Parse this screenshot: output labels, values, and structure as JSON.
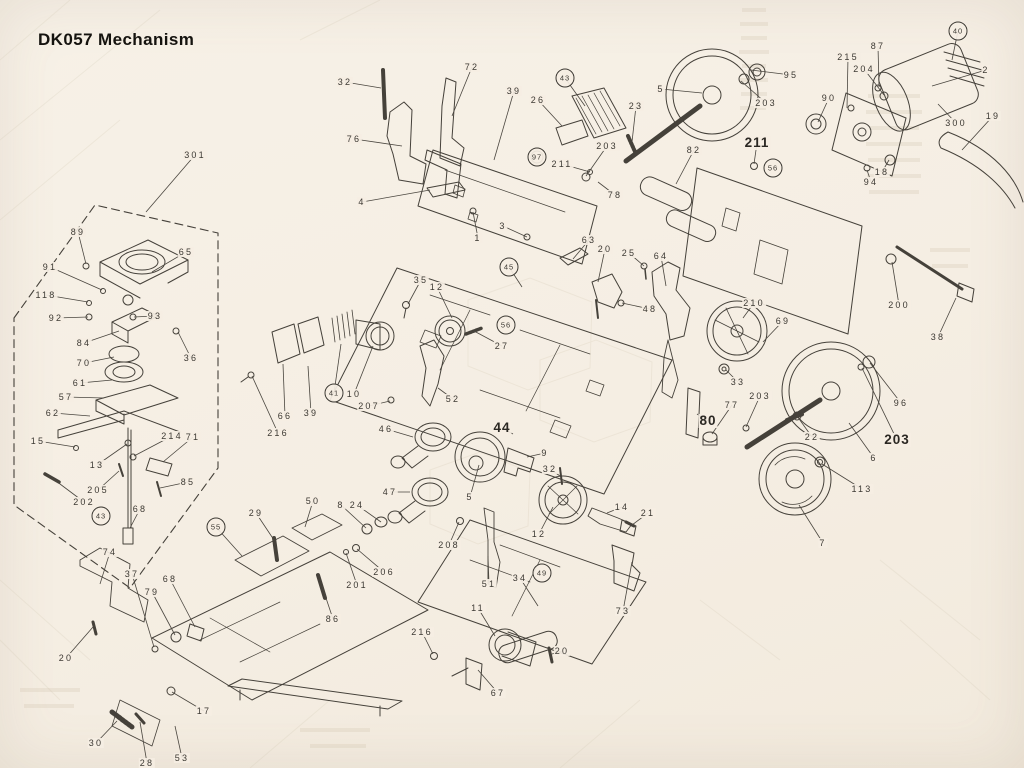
{
  "title": "DK057 Mechanism",
  "document_type": "exploded-view parts diagram (scanned service manual page)",
  "colors": {
    "paper": "#f5eee3",
    "ink": "#45413a",
    "title_ink": "#15130f",
    "ghost_bleedthrough": "#d6cab7"
  },
  "diagram": {
    "description": "Exploded isometric mechanism drawing with numbered part callouts and leader lines; a dashed boundary encloses a sub-assembly at left.",
    "label_styles": {
      "plain": "small letter-spaced number",
      "b": "large bold number",
      "c": "number inside circle"
    },
    "labels": [
      {
        "n": "301",
        "x": 195,
        "y": 155,
        "t": [
          146,
          212
        ]
      },
      {
        "n": "89",
        "x": 78,
        "y": 232,
        "t": [
          86,
          264
        ]
      },
      {
        "n": "65",
        "x": 186,
        "y": 252,
        "t": [
          152,
          272
        ]
      },
      {
        "n": "91",
        "x": 50,
        "y": 267,
        "t": [
          102,
          290
        ]
      },
      {
        "n": "118",
        "x": 46,
        "y": 295,
        "t": [
          88,
          302
        ]
      },
      {
        "n": "92",
        "x": 56,
        "y": 318,
        "t": [
          88,
          317
        ]
      },
      {
        "n": "93",
        "x": 155,
        "y": 316,
        "t": [
          134,
          317
        ]
      },
      {
        "n": "84",
        "x": 84,
        "y": 343,
        "t": [
          119,
          331
        ]
      },
      {
        "n": "36",
        "x": 191,
        "y": 358,
        "t": [
          178,
          332
        ]
      },
      {
        "n": "70",
        "x": 84,
        "y": 363,
        "t": [
          114,
          357
        ]
      },
      {
        "n": "61",
        "x": 80,
        "y": 383,
        "t": [
          112,
          380
        ]
      },
      {
        "n": "57",
        "x": 66,
        "y": 397,
        "t": [
          104,
          398
        ]
      },
      {
        "n": "62",
        "x": 53,
        "y": 413,
        "t": [
          90,
          416
        ]
      },
      {
        "n": "15",
        "x": 38,
        "y": 441,
        "t": [
          75,
          447
        ]
      },
      {
        "n": "13",
        "x": 97,
        "y": 465,
        "t": [
          127,
          444
        ]
      },
      {
        "n": "214",
        "x": 172,
        "y": 436,
        "t": [
          134,
          456
        ]
      },
      {
        "n": "71",
        "x": 193,
        "y": 437,
        "t": [
          163,
          462
        ]
      },
      {
        "n": "205",
        "x": 98,
        "y": 490,
        "t": [
          119,
          471
        ]
      },
      {
        "n": "85",
        "x": 188,
        "y": 482,
        "t": [
          160,
          488
        ]
      },
      {
        "n": "202",
        "x": 84,
        "y": 502,
        "t": [
          52,
          478
        ]
      },
      {
        "n": "43",
        "x": 101,
        "y": 516,
        "s": "c"
      },
      {
        "n": "68",
        "x": 140,
        "y": 509,
        "t": [
          130,
          528
        ]
      },
      {
        "n": "74",
        "x": 110,
        "y": 552,
        "t": [
          100,
          584
        ]
      },
      {
        "n": "37",
        "x": 132,
        "y": 574,
        "t": [
          154,
          647
        ]
      },
      {
        "n": "79",
        "x": 152,
        "y": 592,
        "t": [
          175,
          635
        ]
      },
      {
        "n": "68",
        "x": 170,
        "y": 579,
        "t": [
          195,
          627
        ]
      },
      {
        "n": "20",
        "x": 66,
        "y": 658,
        "t": [
          93,
          627
        ]
      },
      {
        "n": "17",
        "x": 204,
        "y": 711,
        "t": [
          172,
          692
        ]
      },
      {
        "n": "30",
        "x": 96,
        "y": 743,
        "t": [
          117,
          721
        ]
      },
      {
        "n": "28",
        "x": 147,
        "y": 763,
        "t": [
          140,
          722
        ]
      },
      {
        "n": "53",
        "x": 182,
        "y": 758,
        "t": [
          175,
          726
        ]
      },
      {
        "n": "29",
        "x": 256,
        "y": 513,
        "t": [
          274,
          540
        ]
      },
      {
        "n": "50",
        "x": 313,
        "y": 501,
        "t": [
          305,
          527
        ]
      },
      {
        "n": "55",
        "x": 216,
        "y": 527,
        "s": "c",
        "t": [
          242,
          556
        ]
      },
      {
        "n": "86",
        "x": 333,
        "y": 619,
        "t": [
          322,
          586
        ]
      },
      {
        "n": "201",
        "x": 357,
        "y": 585,
        "t": [
          346,
          553
        ]
      },
      {
        "n": "206",
        "x": 384,
        "y": 572,
        "t": [
          357,
          549
        ]
      },
      {
        "n": "8",
        "x": 341,
        "y": 505,
        "t": [
          366,
          528
        ]
      },
      {
        "n": "24",
        "x": 357,
        "y": 505,
        "t": [
          381,
          522
        ]
      },
      {
        "n": "208",
        "x": 449,
        "y": 545,
        "t": [
          459,
          522
        ]
      },
      {
        "n": "216",
        "x": 422,
        "y": 632,
        "t": [
          433,
          654
        ]
      },
      {
        "n": "11",
        "x": 478,
        "y": 608,
        "t": [
          495,
          636
        ]
      },
      {
        "n": "67",
        "x": 498,
        "y": 693,
        "t": [
          478,
          670
        ]
      },
      {
        "n": "20",
        "x": 562,
        "y": 651,
        "t": [
          552,
          654
        ]
      },
      {
        "n": "34",
        "x": 520,
        "y": 578,
        "t": [
          538,
          606
        ]
      },
      {
        "n": "49",
        "x": 542,
        "y": 573,
        "s": "c"
      },
      {
        "n": "51",
        "x": 489,
        "y": 584,
        "t": [
          488,
          556
        ]
      },
      {
        "n": "73",
        "x": 623,
        "y": 611,
        "t": [
          632,
          562
        ]
      },
      {
        "n": "12",
        "x": 539,
        "y": 534,
        "t": [
          553,
          507
        ]
      },
      {
        "n": "14",
        "x": 622,
        "y": 507,
        "t": [
          607,
          513
        ]
      },
      {
        "n": "21",
        "x": 648,
        "y": 513,
        "t": [
          632,
          525
        ]
      },
      {
        "n": "7",
        "x": 823,
        "y": 543,
        "t": [
          799,
          505
        ]
      },
      {
        "n": "113",
        "x": 862,
        "y": 489,
        "t": [
          822,
          464
        ]
      },
      {
        "n": "203",
        "x": 897,
        "y": 440,
        "t": [
          862,
          368
        ],
        "s": "b"
      },
      {
        "n": "96",
        "x": 901,
        "y": 403,
        "t": [
          870,
          363
        ]
      },
      {
        "n": "6",
        "x": 874,
        "y": 458,
        "t": [
          849,
          423
        ]
      },
      {
        "n": "22",
        "x": 812,
        "y": 437,
        "t": [
          797,
          416
        ]
      },
      {
        "n": "77",
        "x": 732,
        "y": 405,
        "t": [
          712,
          434
        ]
      },
      {
        "n": "203",
        "x": 760,
        "y": 396,
        "t": [
          746,
          427
        ]
      },
      {
        "n": "80",
        "x": 708,
        "y": 421,
        "t": [
          697,
          414
        ],
        "s": "b"
      },
      {
        "n": "33",
        "x": 738,
        "y": 382,
        "t": [
          726,
          370
        ]
      },
      {
        "n": "69",
        "x": 783,
        "y": 321,
        "t": [
          763,
          342
        ]
      },
      {
        "n": "210",
        "x": 754,
        "y": 303,
        "t": [
          743,
          318
        ]
      },
      {
        "n": "200",
        "x": 899,
        "y": 305,
        "t": [
          892,
          262
        ]
      },
      {
        "n": "38",
        "x": 938,
        "y": 337,
        "t": [
          956,
          298
        ]
      },
      {
        "n": "19",
        "x": 993,
        "y": 116,
        "t": [
          962,
          150
        ]
      },
      {
        "n": "300",
        "x": 956,
        "y": 123,
        "t": [
          938,
          104
        ]
      },
      {
        "n": "2",
        "x": 986,
        "y": 70,
        "t": [
          932,
          86
        ]
      },
      {
        "n": "40",
        "x": 958,
        "y": 31,
        "s": "c",
        "t": [
          952,
          60
        ]
      },
      {
        "n": "87",
        "x": 878,
        "y": 46,
        "t": [
          879,
          87
        ]
      },
      {
        "n": "204",
        "x": 864,
        "y": 69,
        "t": [
          884,
          95
        ]
      },
      {
        "n": "215",
        "x": 848,
        "y": 57,
        "t": [
          847,
          108
        ]
      },
      {
        "n": "94",
        "x": 871,
        "y": 182,
        "t": [
          867,
          170
        ]
      },
      {
        "n": "18",
        "x": 882,
        "y": 172,
        "t": [
          889,
          160
        ]
      },
      {
        "n": "90",
        "x": 829,
        "y": 98,
        "t": [
          818,
          122
        ]
      },
      {
        "n": "95",
        "x": 791,
        "y": 75,
        "t": [
          751,
          70
        ]
      },
      {
        "n": "203",
        "x": 766,
        "y": 103,
        "t": [
          741,
          81
        ]
      },
      {
        "n": "5",
        "x": 661,
        "y": 89,
        "t": [
          702,
          93
        ]
      },
      {
        "n": "23",
        "x": 636,
        "y": 106,
        "t": [
          632,
          142
        ]
      },
      {
        "n": "82",
        "x": 694,
        "y": 150,
        "t": [
          676,
          184
        ]
      },
      {
        "n": "78",
        "x": 615,
        "y": 195,
        "t": [
          598,
          182
        ]
      },
      {
        "n": "211",
        "x": 757,
        "y": 143,
        "t": [
          754,
          164
        ],
        "s": "b"
      },
      {
        "n": "56",
        "x": 773,
        "y": 168,
        "s": "c"
      },
      {
        "n": "32",
        "x": 345,
        "y": 82,
        "t": [
          381,
          88
        ]
      },
      {
        "n": "72",
        "x": 472,
        "y": 67,
        "t": [
          452,
          116
        ]
      },
      {
        "n": "76",
        "x": 354,
        "y": 139,
        "t": [
          402,
          146
        ]
      },
      {
        "n": "4",
        "x": 362,
        "y": 202,
        "t": [
          430,
          190
        ]
      },
      {
        "n": "39",
        "x": 514,
        "y": 91,
        "t": [
          494,
          160
        ]
      },
      {
        "n": "26",
        "x": 538,
        "y": 100,
        "t": [
          562,
          126
        ]
      },
      {
        "n": "43",
        "x": 565,
        "y": 78,
        "s": "c",
        "t": [
          585,
          106
        ]
      },
      {
        "n": "97",
        "x": 537,
        "y": 157,
        "s": "c"
      },
      {
        "n": "211",
        "x": 562,
        "y": 164,
        "t": [
          590,
          172
        ]
      },
      {
        "n": "203",
        "x": 607,
        "y": 146,
        "t": [
          586,
          176
        ]
      },
      {
        "n": "1",
        "x": 478,
        "y": 238,
        "t": [
          473,
          212
        ]
      },
      {
        "n": "3",
        "x": 503,
        "y": 226,
        "t": [
          527,
          237
        ]
      },
      {
        "n": "63",
        "x": 589,
        "y": 240,
        "t": [
          573,
          259
        ]
      },
      {
        "n": "20",
        "x": 605,
        "y": 249,
        "t": [
          598,
          282
        ]
      },
      {
        "n": "25",
        "x": 629,
        "y": 253,
        "t": [
          644,
          266
        ]
      },
      {
        "n": "64",
        "x": 661,
        "y": 256,
        "t": [
          666,
          286
        ]
      },
      {
        "n": "48",
        "x": 650,
        "y": 309,
        "t": [
          622,
          303
        ]
      },
      {
        "n": "35",
        "x": 421,
        "y": 280,
        "t": [
          408,
          304
        ]
      },
      {
        "n": "12",
        "x": 437,
        "y": 287,
        "t": [
          452,
          318
        ]
      },
      {
        "n": "27",
        "x": 502,
        "y": 346,
        "t": [
          474,
          331
        ]
      },
      {
        "n": "45",
        "x": 509,
        "y": 267,
        "s": "c",
        "t": [
          522,
          287
        ]
      },
      {
        "n": "56",
        "x": 506,
        "y": 325,
        "s": "c"
      },
      {
        "n": "41",
        "x": 334,
        "y": 393,
        "s": "c",
        "t": [
          341,
          344
        ]
      },
      {
        "n": "10",
        "x": 354,
        "y": 394,
        "t": [
          373,
          346
        ]
      },
      {
        "n": "207",
        "x": 369,
        "y": 406,
        "t": [
          390,
          401
        ]
      },
      {
        "n": "39",
        "x": 311,
        "y": 413,
        "t": [
          308,
          366
        ]
      },
      {
        "n": "66",
        "x": 285,
        "y": 416,
        "t": [
          283,
          364
        ]
      },
      {
        "n": "216",
        "x": 278,
        "y": 433,
        "t": [
          252,
          376
        ]
      },
      {
        "n": "52",
        "x": 453,
        "y": 399,
        "t": [
          438,
          388
        ]
      },
      {
        "n": "46",
        "x": 386,
        "y": 429,
        "t": [
          413,
          437
        ]
      },
      {
        "n": "47",
        "x": 390,
        "y": 492,
        "t": [
          410,
          492
        ]
      },
      {
        "n": "44",
        "x": 502,
        "y": 428,
        "t": [
          513,
          434
        ],
        "s": "b"
      },
      {
        "n": "9",
        "x": 545,
        "y": 453,
        "t": [
          527,
          457
        ]
      },
      {
        "n": "32",
        "x": 550,
        "y": 469,
        "t": [
          560,
          476
        ]
      },
      {
        "n": "5",
        "x": 470,
        "y": 497,
        "t": [
          479,
          465
        ]
      }
    ]
  }
}
